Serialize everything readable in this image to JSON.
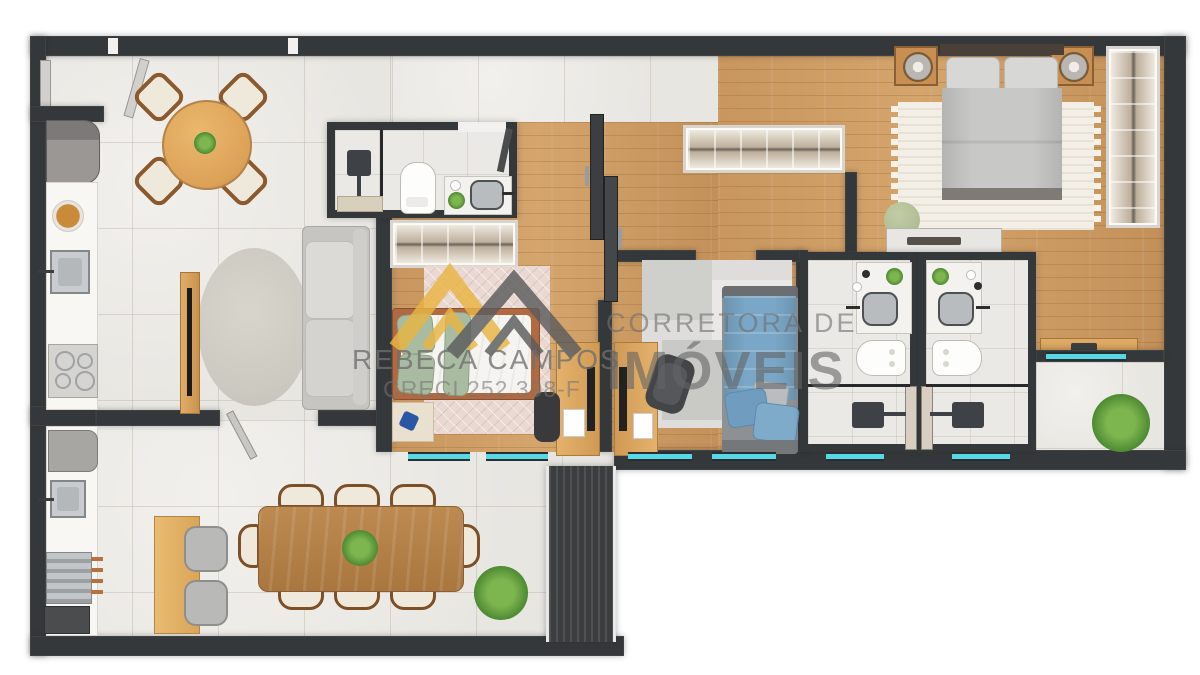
{
  "title": "Apartment floor plan — top view architectural render",
  "watermark": {
    "brand": "REBECA CAMPOS",
    "license": "CRECI 252.398-F",
    "tagline_top": "CORRETORA DE",
    "tagline_bottom": "IMÓVEIS",
    "text_color": "#6e6e6e",
    "logo": {
      "roof_left_color": "#e9b544",
      "roof_right_color": "#5c5c5e"
    }
  },
  "palette": {
    "wall": "#35383a",
    "tile_floor": "#eceae6",
    "wood_floor": "#cb9a62",
    "window_glass": "#57d8e6",
    "counter_white": "#fbfaf8",
    "dining_table_wood": "#b5824b",
    "round_table_wood": "#e2ab62",
    "bed_blue": "#7aa7c7",
    "pillow_green": "#a9bba1",
    "plant_green": "#4e8a33",
    "rug_white": "#f3efe7"
  },
  "furniture": [
    "entry-door",
    "round-dining-table",
    "dining-chair",
    "refrigerator",
    "kitchen-counter",
    "fruit-bowl",
    "kitchen-sink",
    "cooktop",
    "built-in-oven",
    "tv-panel",
    "tv",
    "round-rug",
    "sofa",
    "shower",
    "toilet",
    "vanity-sink",
    "wardrobe-closet",
    "sliding-door",
    "single-bed-green",
    "desk",
    "office-chair",
    "single-bed-blue",
    "double-bed",
    "nightstand",
    "table-lamp",
    "area-rug",
    "tall-wardrobe",
    "dresser",
    "pouf",
    "bathroom-suite",
    "balcony-plant",
    "dining-table-8-seats",
    "sideboard",
    "slatted-partition",
    "decor-plant"
  ]
}
